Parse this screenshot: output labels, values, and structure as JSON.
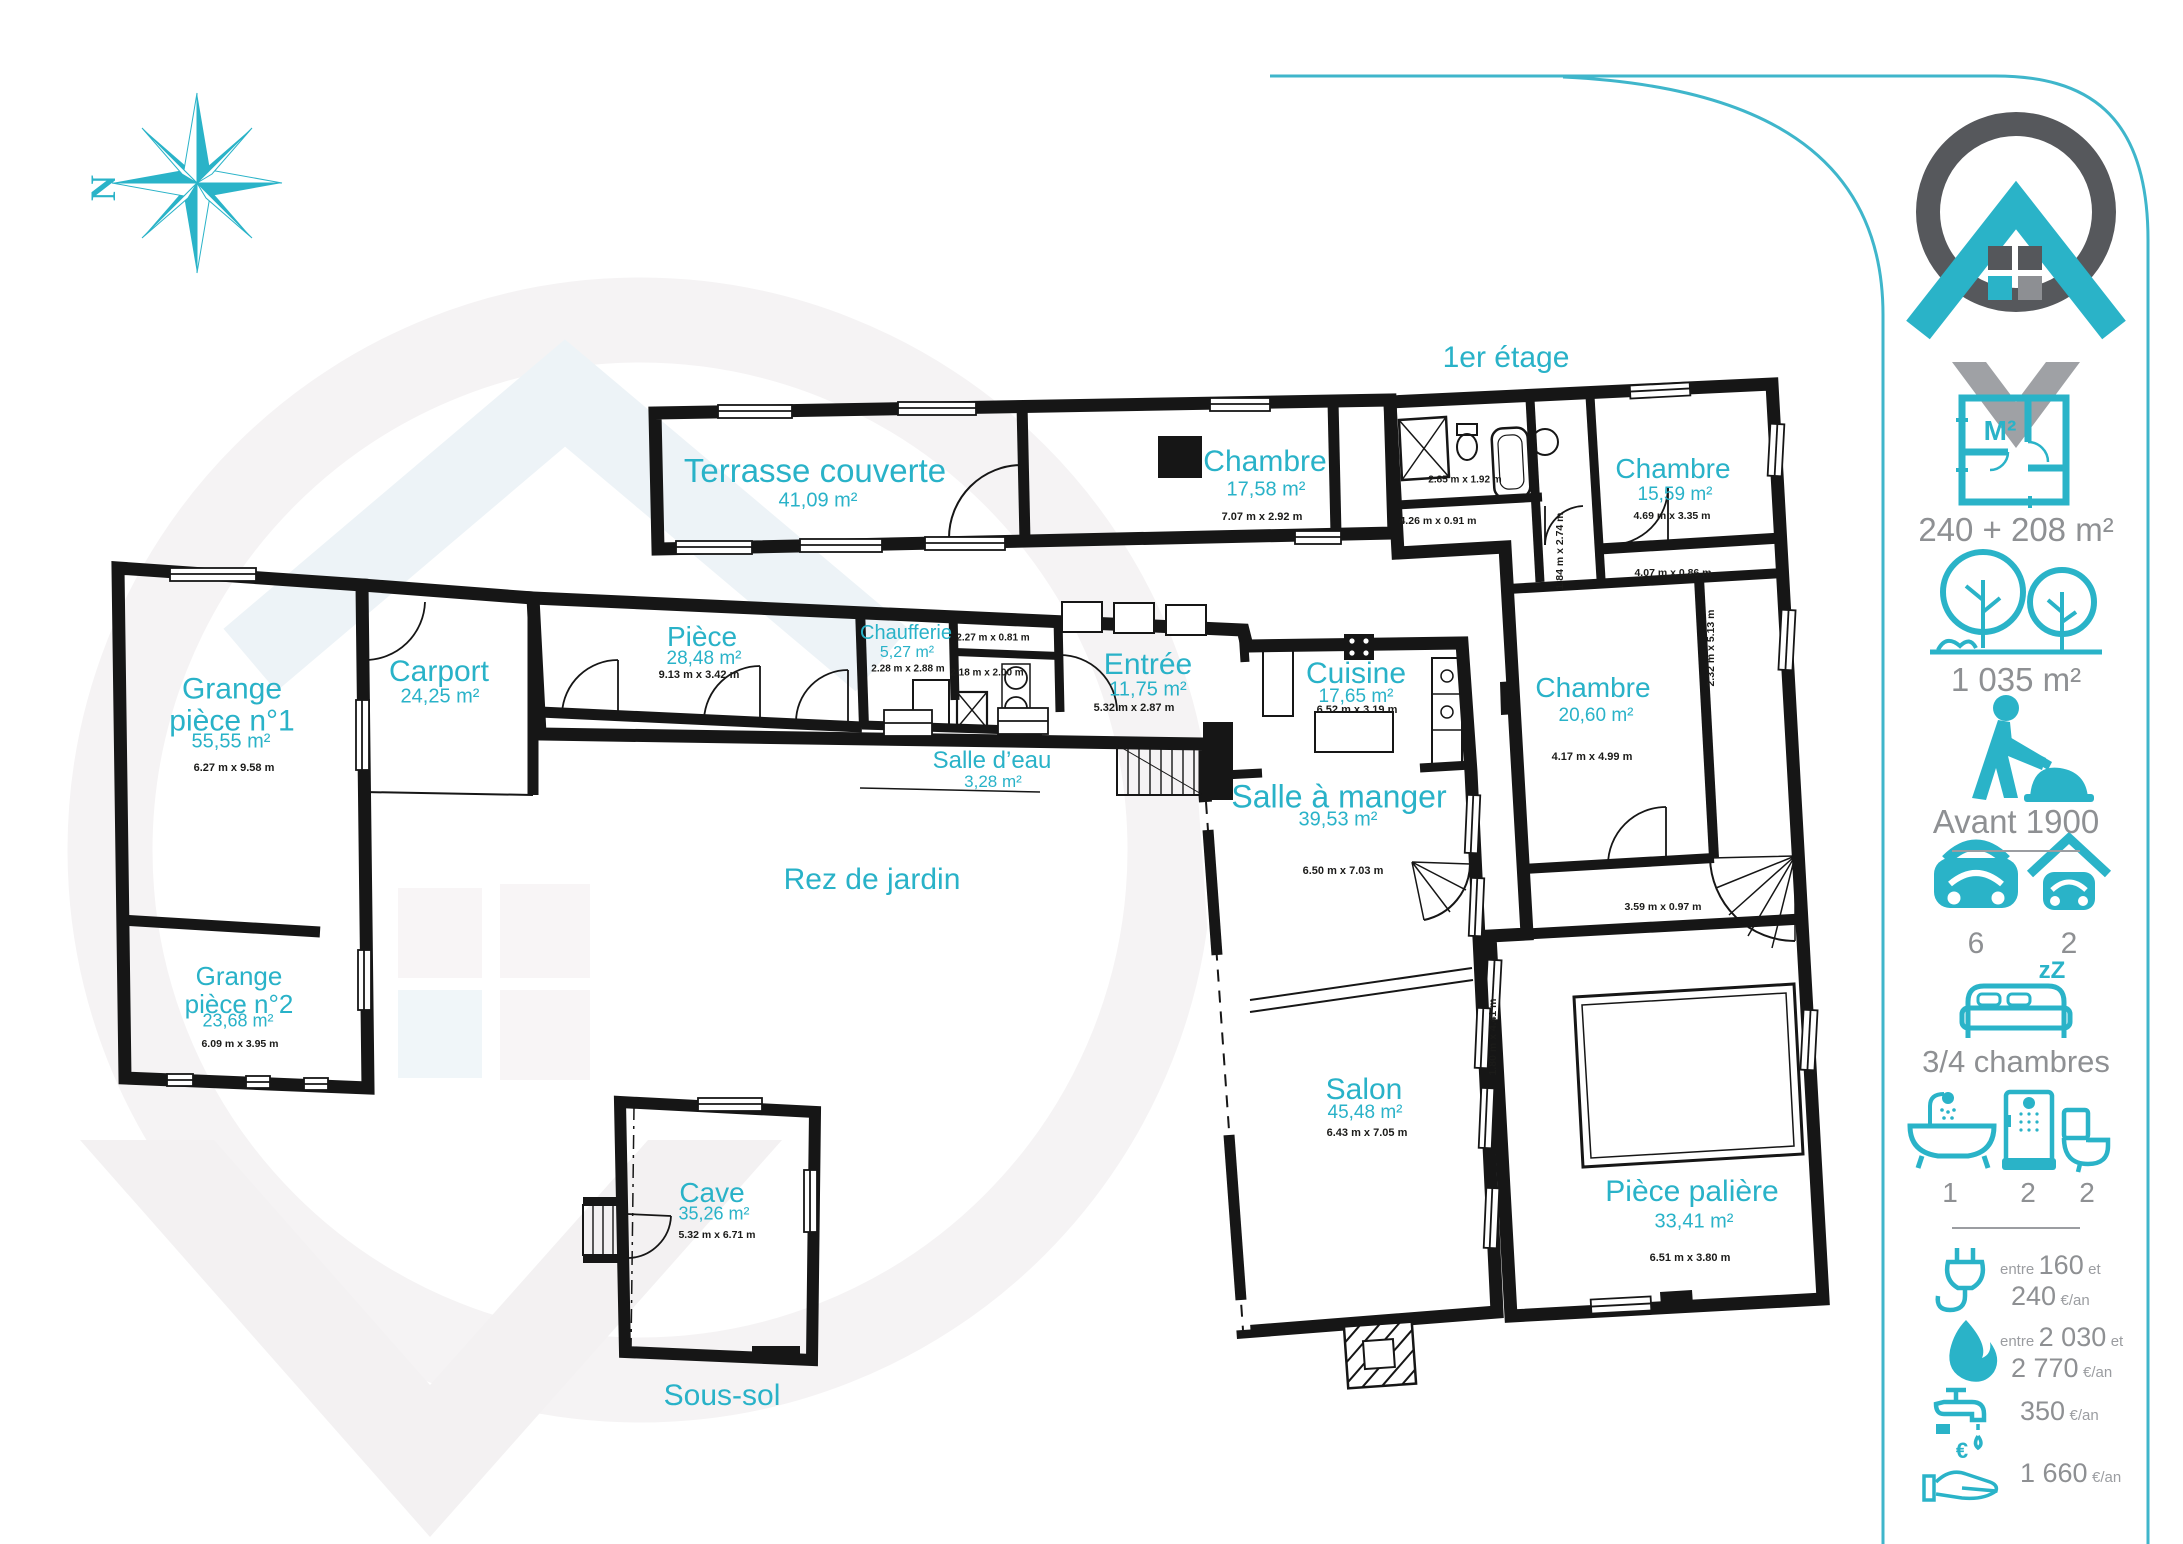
{
  "colors": {
    "accent": "#29b2c8",
    "gray": "#8e9093",
    "dark": "#55575b",
    "plan": "#161616"
  },
  "icons": {
    "north": "N",
    "m2": "M²",
    "zz": "zZ",
    "euro": "€"
  },
  "floors": {
    "first": "1er étage",
    "ground": "Rez de jardin",
    "basement": "Sous-sol"
  },
  "rooms": [
    {
      "name": "Terrasse couverte",
      "area": "41,09 m²",
      "dims": ""
    },
    {
      "name": "Chambre",
      "area": "17,58 m²",
      "dims": "7.07 m x 2.92 m"
    },
    {
      "name": "Chambre",
      "area": "15,59 m²",
      "dims": "4.69 m x 3.35 m"
    },
    {
      "name": "Chambre",
      "area": "20,60 m²",
      "dims": "4.17 m x 4.99 m"
    },
    {
      "name": "Pièce palière",
      "area": "33,41 m²",
      "dims": "6.51 m x 3.80 m"
    },
    {
      "name": "Grange\npièce n°1",
      "area": "55,55 m²",
      "dims": "6.27 m x 9.58 m"
    },
    {
      "name": "Carport",
      "area": "24,25 m²",
      "dims": ""
    },
    {
      "name": "Pièce",
      "area": "28,48 m²",
      "dims": "9.13 m x 3.42 m"
    },
    {
      "name": "Chaufferie",
      "area": "5,27 m²",
      "dims": "2.28 m x 2.88 m"
    },
    {
      "name": "Entrée",
      "area": "11,75 m²",
      "dims": "5.32 m x 2.87 m"
    },
    {
      "name": "Cuisine",
      "area": "17,65 m²",
      "dims": "6.52 m x 3.19 m"
    },
    {
      "name": "Salle d’eau",
      "area": "3,28 m²",
      "dims": ""
    },
    {
      "name": "Salle à manger",
      "area": "39,53 m²",
      "dims": "6.50 m x 7.03 m"
    },
    {
      "name": "Grange\npièce n°2",
      "area": "23,68 m²",
      "dims": "6.09 m x 3.95 m"
    },
    {
      "name": "Salon",
      "area": "45,48 m²",
      "dims": "6.43 m x 7.05 m"
    },
    {
      "name": "Cave",
      "area": "35,26 m²",
      "dims": "5.32 m x 6.71 m"
    }
  ],
  "measurements": [
    "2.85 m x 1.92 m",
    "4.26 m x 0.91 m",
    "1.84 m x 2.74 m",
    "4.07 m x 0.86 m",
    "2.32 m x 5.13 m",
    "3.59 m x 0.97 m",
    "1.80 m x 4.41 m",
    "2.27 m x 0.81 m",
    "2.18 m x 2.00 m"
  ],
  "sidebar": {
    "surface": {
      "value": "240 + 208 m²"
    },
    "land": {
      "value": "1 035 m²"
    },
    "year": {
      "value": "Avant 1900"
    },
    "parking": {
      "count": "6"
    },
    "garage": {
      "count": "2"
    },
    "bedrooms": {
      "label": "3/4 chambres"
    },
    "bath": {
      "count": "1"
    },
    "shower": {
      "count": "2"
    },
    "wc": {
      "count": "2"
    },
    "electricity": {
      "prefix": "entre",
      "v1": "160",
      "mid": "et",
      "v2": "240",
      "suffix": "€/an"
    },
    "gas": {
      "prefix": "entre",
      "v1": "2 030",
      "mid": "et",
      "v2": "2 770",
      "suffix": "€/an"
    },
    "water": {
      "value": "350",
      "suffix": "€/an"
    },
    "tax": {
      "value": "1 660",
      "suffix": "€/an"
    }
  }
}
